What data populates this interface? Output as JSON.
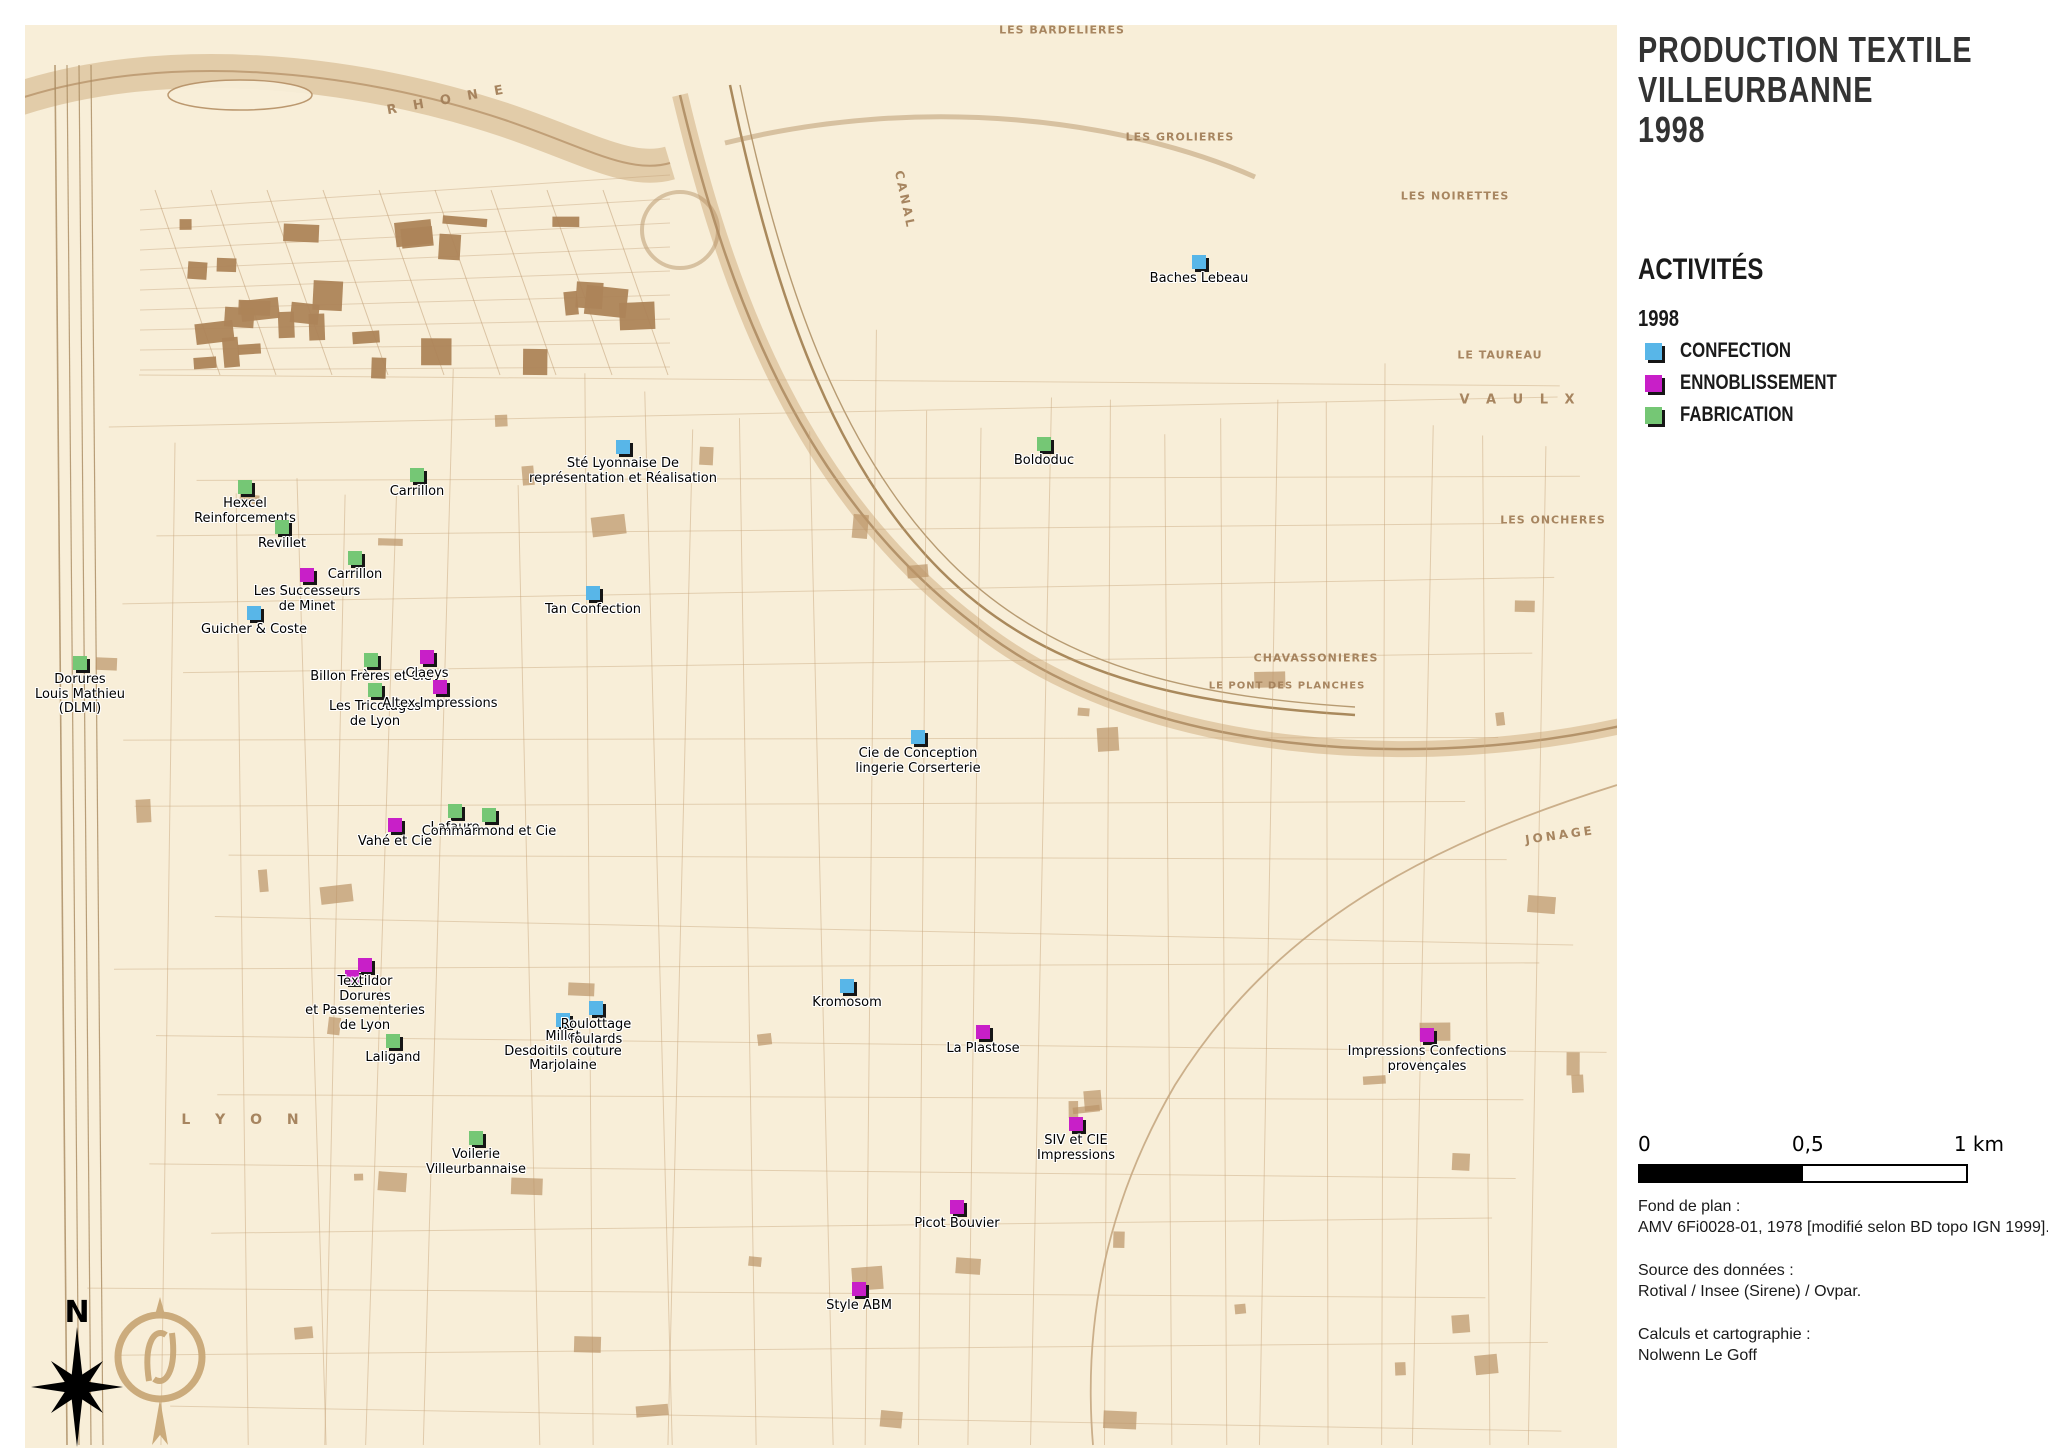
{
  "panel": {
    "title_lines": [
      "PRODUCTION TEXTILE",
      "VILLEURBANNE",
      "1998"
    ],
    "legend": {
      "heading": "ACTIVITÉS",
      "year": "1998",
      "items": [
        {
          "key": "confection",
          "label": "CONFECTION",
          "color": "#58b6e8"
        },
        {
          "key": "ennoblissement",
          "label": "ENNOBLISSEMENT",
          "color": "#c81fc8"
        },
        {
          "key": "fabrication",
          "label": "FABRICATION",
          "color": "#75c775"
        }
      ]
    },
    "scalebar": {
      "start": "0",
      "middle": "0,5",
      "end": "1 km"
    },
    "credits": [
      {
        "title": "Fond de plan :",
        "text": "AMV 6Fi0028-01, 1978 [modifié selon BD topo IGN 1999]."
      },
      {
        "title": "Source des données :",
        "text": "Rotival / Insee (Sirene) / Ovpar."
      },
      {
        "title": "Calculs et cartographie :",
        "text": "Nolwenn Le Goff"
      }
    ]
  },
  "map": {
    "compass_label": "N",
    "place_labels": [
      {
        "text": "R H O N E",
        "x": 448,
        "y": 100,
        "size": 13,
        "ls": 6,
        "rot": -10
      },
      {
        "text": "CANAL",
        "x": 905,
        "y": 200,
        "size": 12,
        "ls": 3,
        "rot": 78
      },
      {
        "text": "L Y O N",
        "x": 245,
        "y": 1120,
        "size": 14,
        "ls": 10,
        "rot": 0
      },
      {
        "text": "JONAGE",
        "x": 1560,
        "y": 835,
        "size": 12,
        "ls": 3,
        "rot": -8
      },
      {
        "text": "V A U L X",
        "x": 1520,
        "y": 400,
        "size": 13,
        "ls": 6,
        "rot": 0
      },
      {
        "text": "LES BARDELIERES",
        "x": 1062,
        "y": 30,
        "size": 11,
        "ls": 1,
        "rot": 0
      },
      {
        "text": "LES GROLIERES",
        "x": 1180,
        "y": 137,
        "size": 11,
        "ls": 1,
        "rot": 0
      },
      {
        "text": "LES NOIRETTES",
        "x": 1455,
        "y": 196,
        "size": 11,
        "ls": 1,
        "rot": 0
      },
      {
        "text": "LE TAUREAU",
        "x": 1500,
        "y": 355,
        "size": 11,
        "ls": 1,
        "rot": 0
      },
      {
        "text": "LES ONCHERES",
        "x": 1553,
        "y": 520,
        "size": 11,
        "ls": 1,
        "rot": 0
      },
      {
        "text": "CHAVASSONIERES",
        "x": 1316,
        "y": 658,
        "size": 11,
        "ls": 1,
        "rot": 0
      },
      {
        "text": "LE PONT DES PLANCHES",
        "x": 1287,
        "y": 686,
        "size": 10,
        "ls": 1,
        "rot": 0
      }
    ],
    "markers": [
      {
        "name": "Baches Lebeau",
        "category": "confection",
        "x": 1199,
        "y": 262,
        "label_lines": [
          "Baches Lebeau"
        ]
      },
      {
        "name": "Boldoduc",
        "category": "fabrication",
        "x": 1044,
        "y": 444,
        "label_lines": [
          "Boldoduc"
        ]
      },
      {
        "name": "Hexcel Reinforcements",
        "category": "fabrication",
        "x": 245,
        "y": 487,
        "label_lines": [
          "Hexcel",
          "Reinforcements"
        ]
      },
      {
        "name": "Carrillon",
        "category": "fabrication",
        "x": 417,
        "y": 475,
        "label_lines": [
          "Carrillon"
        ]
      },
      {
        "name": "Revillet",
        "category": "fabrication",
        "x": 282,
        "y": 527,
        "label_lines": [
          "Revillet"
        ]
      },
      {
        "name": "Carrillon",
        "category": "fabrication",
        "x": 355,
        "y": 558,
        "label_lines": [
          "Carrillon"
        ]
      },
      {
        "name": "Les Successeurs de Minet",
        "category": "ennoblissement",
        "x": 307,
        "y": 575,
        "label_lines": [
          "Les Successeurs",
          "de Minet"
        ]
      },
      {
        "name": "Guicher & Coste",
        "category": "confection",
        "x": 254,
        "y": 613,
        "label_lines": [
          "Guicher & Coste"
        ]
      },
      {
        "name": "Dorures Louis Mathieu (DLMI)",
        "category": "fabrication",
        "x": 80,
        "y": 663,
        "label_lines": [
          "Dorures",
          "Louis Mathieu",
          "(DLMI)"
        ]
      },
      {
        "name": "Billon Frères et Cie",
        "category": "fabrication",
        "x": 371,
        "y": 660,
        "label_lines": [
          "Billon Frères et Cie"
        ]
      },
      {
        "name": "Claeys",
        "category": "ennoblissement",
        "x": 427,
        "y": 657,
        "label_lines": [
          "Claeys"
        ]
      },
      {
        "name": "Les Tricotages de Lyon",
        "category": "fabrication",
        "x": 375,
        "y": 690,
        "label_lines": [
          "Les Tricotages",
          "de Lyon"
        ]
      },
      {
        "name": "Altex Impressions",
        "category": "ennoblissement",
        "x": 440,
        "y": 687,
        "label_lines": [
          "Altex Impressions"
        ]
      },
      {
        "name": "Sté Lyonnaise De représentation et Réalisation",
        "category": "confection",
        "x": 623,
        "y": 447,
        "label_lines": [
          "Sté Lyonnaise De",
          "représentation et Réalisation"
        ]
      },
      {
        "name": "Tan Confection",
        "category": "confection",
        "x": 593,
        "y": 593,
        "label_lines": [
          "Tan Confection"
        ]
      },
      {
        "name": "Cie de Conception lingerie Corserterie",
        "category": "confection",
        "x": 918,
        "y": 737,
        "label_lines": [
          "Cie de Conception",
          "lingerie Corserterie"
        ]
      },
      {
        "name": "Lafaure",
        "category": "fabrication",
        "x": 455,
        "y": 811,
        "label_lines": [
          "Lafaure"
        ]
      },
      {
        "name": "Commarmond et Cie",
        "category": "fabrication",
        "x": 489,
        "y": 815,
        "label_lines": [
          "Commarmond et Cie"
        ]
      },
      {
        "name": "Vahé et Cie",
        "category": "ennoblissement",
        "x": 395,
        "y": 825,
        "label_lines": [
          "Vahé et Cie"
        ]
      },
      {
        "name": "Dorures et Passementeries de Lyon",
        "category": "ennoblissement",
        "x": 352,
        "y": 977,
        "label_lines": []
      },
      {
        "name": "Textildor",
        "category": "ennoblissement",
        "x": 365,
        "y": 965,
        "label_lines": [
          "Textildor",
          "Dorures",
          "et Passementeries",
          "de Lyon"
        ]
      },
      {
        "name": "Laligand",
        "category": "fabrication",
        "x": 393,
        "y": 1041,
        "label_lines": [
          "Laligand"
        ]
      },
      {
        "name": "Millet Desdoitils couture Marjolaine",
        "category": "confection",
        "x": 563,
        "y": 1020,
        "label_lines": [
          "Millet",
          "Desdoitils couture",
          "Marjolaine"
        ]
      },
      {
        "name": "Roulottage foulards",
        "category": "confection",
        "x": 596,
        "y": 1008,
        "label_lines": [
          "Roulottage",
          "foulards"
        ]
      },
      {
        "name": "Kromosom",
        "category": "confection",
        "x": 847,
        "y": 986,
        "label_lines": [
          "Kromosom"
        ]
      },
      {
        "name": "La Plastose",
        "category": "ennoblissement",
        "x": 983,
        "y": 1032,
        "label_lines": [
          "La Plastose"
        ]
      },
      {
        "name": "SIV et CIE Impressions",
        "category": "ennoblissement",
        "x": 1076,
        "y": 1124,
        "label_lines": [
          "SIV et CIE",
          "Impressions"
        ]
      },
      {
        "name": "Picot Bouvier",
        "category": "ennoblissement",
        "x": 957,
        "y": 1207,
        "label_lines": [
          "Picot Bouvier"
        ]
      },
      {
        "name": "Style ABM",
        "category": "ennoblissement",
        "x": 859,
        "y": 1289,
        "label_lines": [
          "Style ABM"
        ]
      },
      {
        "name": "Impressions Confections provençales",
        "category": "ennoblissement",
        "x": 1427,
        "y": 1035,
        "label_lines": [
          "Impressions Confections",
          "provençales"
        ]
      },
      {
        "name": "Voilerie Villeurbannaise",
        "category": "fabrication",
        "x": 476,
        "y": 1138,
        "label_lines": [
          "Voilerie",
          "Villeurbannaise"
        ]
      }
    ]
  }
}
